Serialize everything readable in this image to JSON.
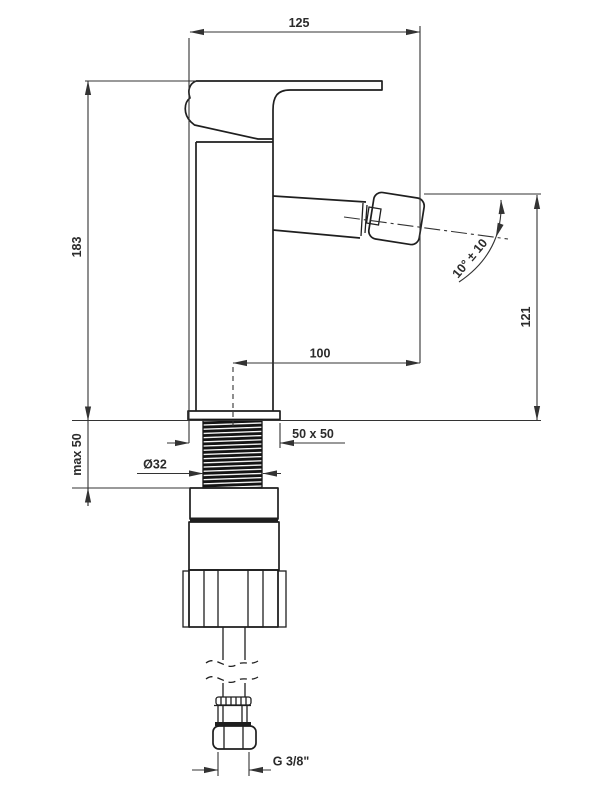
{
  "colors": {
    "background": "#ffffff",
    "line": "#1f1f1f",
    "dim": "#333333",
    "text": "#2b2b2b"
  },
  "labels": {
    "width_top": "125",
    "height_total": "183",
    "deck_thickness": "max 50",
    "shank_diameter": "Ø32",
    "base_plate": "50 x 50",
    "spout_reach": "100",
    "spout_height": "121",
    "spout_angle": "10° ± 10",
    "thread_size": "G 3/8\""
  }
}
